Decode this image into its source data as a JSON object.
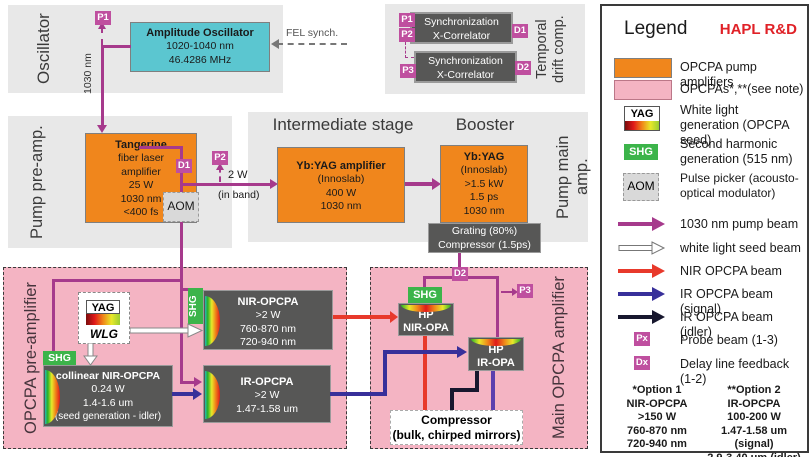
{
  "sections": {
    "oscillator": {
      "label": "Oscillator"
    },
    "temporal_drift": {
      "label_line1": "Temporal",
      "label_line2": "drift comp."
    },
    "pump_pre": {
      "label": "Pump pre-amp."
    },
    "pump_main": {
      "label": "Pump main amp.",
      "intermediate_heading": "Intermediate stage",
      "booster_heading": "Booster"
    },
    "opcpa_pre": {
      "label": "OPCPA pre-amplifier"
    },
    "opcpa_main": {
      "label": "Main OPCPA amplifier"
    }
  },
  "boxes": {
    "amplitude_oscillator": {
      "title": "Amplitude Oscillator",
      "lines": [
        "1020-1040 nm",
        "46.4286 MHz"
      ]
    },
    "sync_correlator_1": {
      "lines": [
        "Synchronization",
        "X-Correlator"
      ]
    },
    "sync_correlator_2": {
      "lines": [
        "Synchronization",
        "X-Correlator"
      ]
    },
    "tangerine": {
      "title": "Tangerine",
      "lines": [
        "fiber laser",
        "amplifier",
        "25 W",
        "1030 nm",
        "<400 fs"
      ]
    },
    "aom": {
      "label": "AOM"
    },
    "yb_yag_amplifier": {
      "title": "Yb:YAG amplifier",
      "lines": [
        "(Innoslab)",
        "400 W",
        "1030 nm"
      ]
    },
    "yb_yag_booster": {
      "title": "Yb:YAG",
      "lines": [
        "(Innoslab)",
        ">1.5 kW",
        "1.5 ps",
        "1030 nm"
      ]
    },
    "grating_compressor": {
      "lines": [
        "Grating (80%)",
        "Compressor (1.5ps)"
      ]
    },
    "wlg": {
      "yag_label": "YAG",
      "wlg_label": "WLG"
    },
    "shg_label": "SHG",
    "collinear_nir_opcpa": {
      "title": "collinear NIR-OPCPA",
      "lines": [
        "0.24 W",
        "1.4-1.6 um",
        "(seed generation - idler)"
      ]
    },
    "nir_opcpa": {
      "title": "NIR-OPCPA",
      "lines": [
        ">2 W",
        "760-870 nm",
        "720-940 nm"
      ]
    },
    "ir_opcpa": {
      "title": "IR-OPCPA",
      "lines": [
        ">2 W",
        "1.47-1.58 um"
      ]
    },
    "hp_nir_opa": {
      "lines": [
        "HP",
        "NIR-OPA"
      ]
    },
    "hp_ir_opa": {
      "lines": [
        "HP",
        "IR-OPA"
      ]
    },
    "final_compressor": {
      "lines": [
        "Compressor",
        "(bulk, chirped mirrors)"
      ]
    }
  },
  "markers": {
    "osc_p1": "P1",
    "sync_p1": "P1",
    "sync_p2": "P2",
    "sync_p3": "P3",
    "sync_d1": "D1",
    "sync_d2": "D2",
    "tangerine_d1": "D1",
    "pump_p2": "P2",
    "main_d2": "D2",
    "main_p3": "P3"
  },
  "annotations": {
    "fel_sync": "FEL synch.",
    "osc_wavelength": "1030 nm",
    "pump_power": "2 W",
    "in_band": "(in band)"
  },
  "legend": {
    "title": "Legend",
    "project": "HAPL R&D",
    "icon_labels": {
      "yag": "YAG",
      "shg": "SHG",
      "aom": "AOM"
    },
    "items": [
      {
        "icon": "orange-swatch",
        "label": "OPCPA pump amplifiers"
      },
      {
        "icon": "pink-swatch",
        "label": "OPCPAs*,**(see note)"
      },
      {
        "icon": "yag-wlg",
        "label": "White light generation (OPCPA seed)"
      },
      {
        "icon": "shg",
        "label": "Second harmonic generation (515 nm)"
      },
      {
        "icon": "aom",
        "label": "Pulse picker (acousto-optical modulator)"
      }
    ],
    "beams": [
      {
        "color": "#a63a8c",
        "style": "solid",
        "label": "1030 nm pump beam"
      },
      {
        "color": "#ffffff",
        "style": "outlined",
        "label": "white light seed beam"
      },
      {
        "color": "#e8392b",
        "style": "solid",
        "label": "NIR OPCPA beam"
      },
      {
        "color": "#38309a",
        "style": "solid",
        "label": "IR OPCPA beam (signal)"
      },
      {
        "color": "#17172e",
        "style": "solid",
        "label": "IR OPCPA beam (idler)"
      }
    ],
    "point_markers": [
      {
        "symbol": "Px",
        "label": "Probe beam (1-3)"
      },
      {
        "symbol": "Dx",
        "label": "Delay line feedback (1-2)"
      }
    ],
    "notes": {
      "option1": [
        "*Option 1",
        "NIR-OPCPA",
        ">150 W",
        "760-870 nm",
        "720-940 nm"
      ],
      "option2": [
        "**Option 2",
        "IR-OPCPA",
        "100-200 W",
        "1.47-1.58 um (signal)",
        "2.9-3.40 um (idler)"
      ]
    }
  },
  "colors": {
    "pump_beam": "#a63a8c",
    "nir_beam": "#e8392b",
    "ir_signal_beam": "#38309a",
    "ir_signal_violet": "#5b3fae",
    "ir_idler_beam": "#17172e",
    "marker_magenta": "#bf4f9f",
    "pump_amp_orange": "#f0861c",
    "opcpa_pink": "#f4b4c3",
    "shg_green": "#3cb44a",
    "oscillator_teal": "#5bc6d0",
    "hapl_red": "#e02127"
  }
}
